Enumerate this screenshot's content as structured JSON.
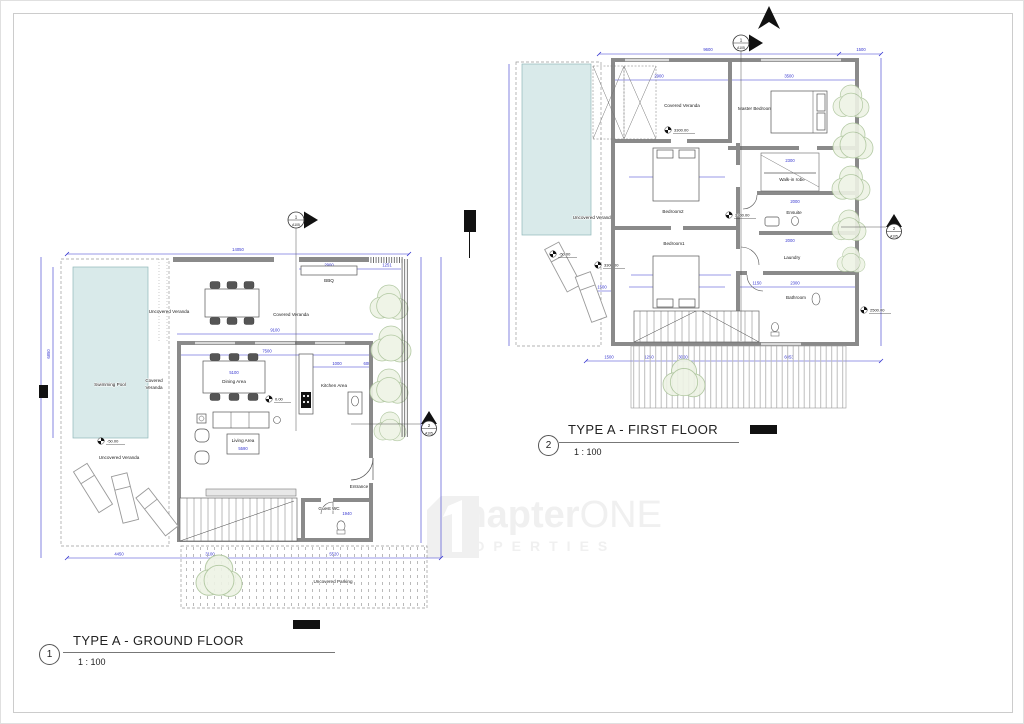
{
  "watermark": {
    "brand_main": "Chapter",
    "brand_accent": "ONE",
    "brand_sub": "PROPERTIES"
  },
  "titles": {
    "ground": {
      "num": "1",
      "label": "TYPE A - GROUND FLOOR",
      "scale": "1 : 100"
    },
    "first": {
      "num": "2",
      "label": "TYPE A - FIRST FLOOR",
      "scale": "1 : 100"
    }
  },
  "markers": {
    "gf_section1": {
      "num": "1",
      "sheet": "A105"
    },
    "gf_section2": {
      "num": "2",
      "sheet": "A105"
    },
    "ff_section1": {
      "num": "1",
      "sheet": "A105"
    },
    "ff_section2": {
      "num": "2",
      "sheet": "A105"
    }
  },
  "ground": {
    "rooms": {
      "swimming_pool": "Swimming Pool",
      "uncovered_veranda_top": "Uncovered Veranda",
      "covered_veranda_side_l1": "Covered",
      "covered_veranda_side_l2": "Veranda",
      "covered_veranda_top": "Covered Veranda",
      "bbq": "BBQ",
      "dining_area": "Dining Area",
      "kitchen_area": "Kitchen Area",
      "living_area": "Living Area",
      "entrance": "Entrance",
      "guest_wc": "Guest WC",
      "uncovered_veranda_bottom": "Uncovered Veranda",
      "uncovered_parking": "Uncovered Parking"
    },
    "levels": {
      "pool_deck": "-50.00",
      "interior": "0.00"
    },
    "dims": {
      "overall_top": "14050",
      "bbq_veranda": "2900",
      "planter": "1251",
      "pool_width": "3000",
      "pool_length": "6850",
      "veranda_span": "9100",
      "interior_span": "7500",
      "dining_table": "5100",
      "kitchen_a": "900",
      "kitchen_b": "1000",
      "kitchen_c": "600",
      "living_width": "5590",
      "wc": "1940",
      "veranda_left": "4450",
      "parking_a": "3100",
      "parking_b": "5520"
    }
  },
  "first": {
    "rooms": {
      "covered_veranda": "Covered Veranda",
      "master_bedroom": "Master Bedroom",
      "bedroom2": "Bedroom2",
      "bedroom1": "Bedroom1",
      "walk_in_robe": "Walk-in robe",
      "ensuite": "Ensuite",
      "laundry": "Laundry",
      "bathroom": "Bathroom",
      "uncovered_veranda": "Uncovered Veranda"
    },
    "levels": {
      "pool_deck": "-50.00",
      "exterior": "3300.00",
      "veranda": "3300.00",
      "hall": "3300.00",
      "bathroom": "2500.00"
    },
    "dims": {
      "overall_top": "9600",
      "top_right": "1500",
      "veranda_top": "2900",
      "master_width": "3500",
      "robe": "2300",
      "ensuite": "2000",
      "laundry": "2000",
      "bath": "2300",
      "hall": "1150",
      "bedroom2_width": "3500",
      "bedroom1_width": "3500",
      "bedroom1_length": "4900",
      "pool_gap": "1500",
      "bottom_a": "1500",
      "bottom_b": "1250",
      "bottom_c": "3000",
      "bottom_d": "6053"
    }
  }
}
